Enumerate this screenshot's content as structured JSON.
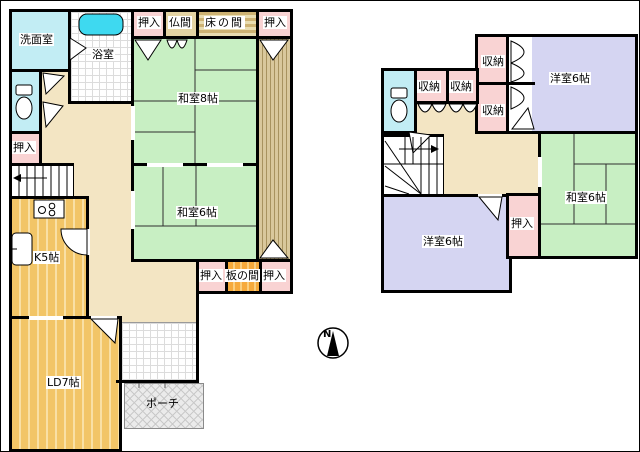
{
  "colors": {
    "wall": "#000000",
    "tatami_green": "#c8efc3",
    "closet_pink": "#f9d3d3",
    "water_cyan": "#c2edf4",
    "bathtub_cyan": "#3ed9f0",
    "hall_beige": "#f3e5c3",
    "western_purple": "#d5d5f2",
    "wood_floor_orange": "#f2c567",
    "butsuma_tan": "#e3d3a3",
    "engawa_tan": "#d9c89c",
    "porch_gray": "#ebebeb"
  },
  "floor1": {
    "washroom_label": "洗面室",
    "bathroom_label": "浴室",
    "closet_label_left": "押入",
    "closet_label_top_a": "押入",
    "butsuma_label": "仏間",
    "tokonoma_label": "床の間",
    "closet_label_top_b": "押入",
    "washitsu8_label": "和室8帖",
    "washitsu6_label": "和室6帖",
    "closet_label_bottom_a": "押入",
    "itanoma_label": "板の間",
    "closet_label_bottom_b": "押入",
    "kitchen_label": "K5帖",
    "living_dining_label": "LD7帖",
    "porch_label": "ポーチ"
  },
  "floor2": {
    "storage_label_a": "収納",
    "storage_label_b": "収納",
    "storage_label_c": "収納",
    "storage_label_d": "収納",
    "western_room_top_label": "洋室6帖",
    "washitsu_label": "和室6帖",
    "closet_label": "押入",
    "western_room_bottom_label": "洋室6帖"
  },
  "compass": {
    "north_label": "N"
  }
}
